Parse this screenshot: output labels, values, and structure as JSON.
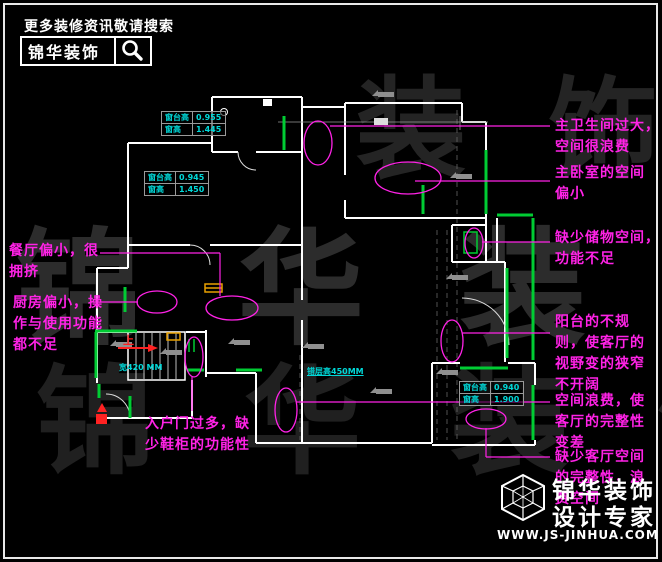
{
  "header": {
    "slogan": "更多装修资讯敬请搜索",
    "brand": "锦华装饰"
  },
  "watermark": {
    "text": "锦 华 装 饰",
    "fragment_top": "装 饰",
    "fragment_bottom": "锦 华 装 饰"
  },
  "plan": {
    "dim_tables": [
      {
        "rows": [
          {
            "label": "窗台高",
            "value": "0.955"
          },
          {
            "label": "窗高",
            "value": "1.445"
          }
        ]
      },
      {
        "rows": [
          {
            "label": "窗台高",
            "value": "0.945"
          },
          {
            "label": "窗高",
            "value": "1.450"
          }
        ]
      },
      {
        "rows": [
          {
            "label": "窗台高",
            "value": "0.940"
          },
          {
            "label": "窗高",
            "value": "1.900"
          }
        ]
      }
    ],
    "labels": {
      "stair_up": "上",
      "width_note": "宽420 MM",
      "split_level_note": "错层高450MM"
    }
  },
  "annotations": {
    "right": [
      {
        "text": "主卫生间过大，\n空间很浪费"
      },
      {
        "text": "主卧室的空间\n偏小"
      },
      {
        "text": "缺少储物空间，\n功能不足"
      },
      {
        "text": "阳台的不规\n则，使客厅的\n视野变的狭窄\n不开阔"
      },
      {
        "text": "空间浪费，使\n客厅的完整性\n变差"
      },
      {
        "text": "缺少客厅空间\n的完整性，浪\n费空间"
      }
    ],
    "left": [
      {
        "text": "餐厅偏小，很\n拥挤"
      },
      {
        "text": "厨房偏小，操\n作与使用功能\n都不足"
      },
      {
        "text": "入户门过多，缺\n少鞋柜的功能性"
      }
    ]
  },
  "footer": {
    "brand_line1": "锦华装饰",
    "brand_line2": "设计专家",
    "website": "WWW.JS-JINHUA.COM"
  },
  "colors": {
    "background": "#000000",
    "walls": "#ffffff",
    "windows": "#00cc33",
    "annotation_magenta": "#ff22e6",
    "dimension_cyan": "#00d8d8",
    "alert_red": "#ff2222",
    "symbol_orange": "#e8a000"
  }
}
